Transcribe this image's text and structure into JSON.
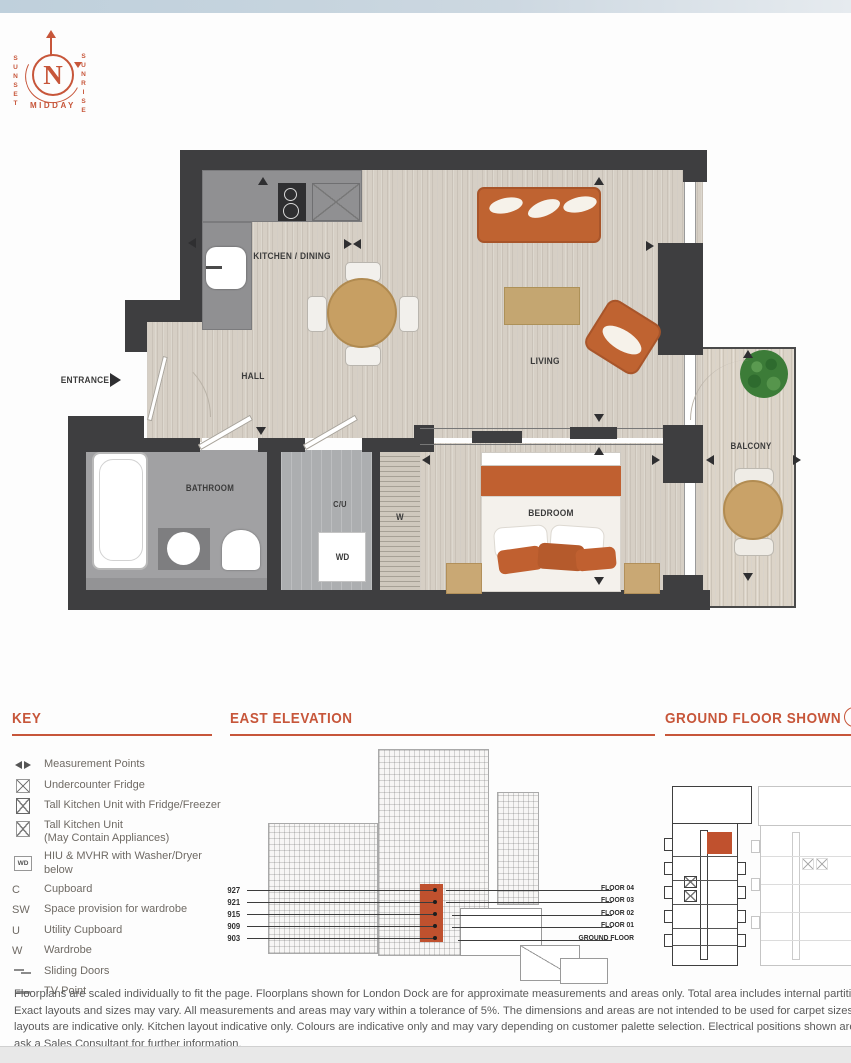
{
  "compass": {
    "north": "N",
    "sunset": "SUNSET",
    "sunrise": "SUNRISE",
    "midday": "MIDDAY"
  },
  "floorplan": {
    "labels": {
      "entrance": "ENTRANCE",
      "kitchen_dining": "KITCHEN / DINING",
      "hall": "HALL",
      "living": "LIVING",
      "bathroom": "BATHROOM",
      "cu": "C/U",
      "wd": "WD",
      "wardrobe": "W",
      "bedroom": "BEDROOM",
      "balcony": "BALCONY"
    }
  },
  "key": {
    "title": "KEY",
    "items": [
      {
        "symbol": "",
        "label": "Measurement Points"
      },
      {
        "symbol": "",
        "label": "Undercounter Fridge"
      },
      {
        "symbol": "",
        "label": "Tall Kitchen Unit with Fridge/Freezer"
      },
      {
        "symbol": "",
        "label": "Tall Kitchen Unit",
        "label2": "(May Contain Appliances)"
      },
      {
        "symbol": "WD",
        "label": "HIU & MVHR with Washer/Dryer below"
      },
      {
        "symbol": "C",
        "label": "Cupboard"
      },
      {
        "symbol": "SW",
        "label": "Space provision for wardrobe"
      },
      {
        "symbol": "U",
        "label": "Utility Cupboard"
      },
      {
        "symbol": "W",
        "label": "Wardrobe"
      },
      {
        "symbol": "",
        "label": "Sliding Doors"
      },
      {
        "symbol": "",
        "label": "TV Point"
      }
    ]
  },
  "elevation": {
    "title": "EAST ELEVATION",
    "unit_numbers": [
      "927",
      "921",
      "915",
      "909",
      "903"
    ],
    "floor_labels": [
      "FLOOR 04",
      "FLOOR 03",
      "FLOOR 02",
      "FLOOR 01",
      "GROUND FLOOR"
    ]
  },
  "ground_floor": {
    "title": "GROUND FLOOR SHOWN"
  },
  "disclaimer": {
    "lines": [
      "Floorplans are scaled individually to fit the page. Floorplans shown for London Dock are for approximate measurements and areas only. Total area includes internal partitions, internal columns and service boxings.",
      "Exact layouts and sizes may vary. All measurements and areas may vary within a tolerance of 5%. The dimensions and areas are not intended to be used for carpet sizes, appliance sizes or items of furniture. Furniture",
      "layouts are indicative only. Kitchen layout indicative only. Colours are indicative only and may vary depending on customer palette selection. Electrical positions shown are indicative only. Views indicative only. Please",
      "ask a Sales Consultant for further information."
    ]
  },
  "colors": {
    "accent": "#c7563a",
    "highlight": "#c0512e",
    "wall": "#3e3e40",
    "furniture_orange": "#bf6331"
  }
}
